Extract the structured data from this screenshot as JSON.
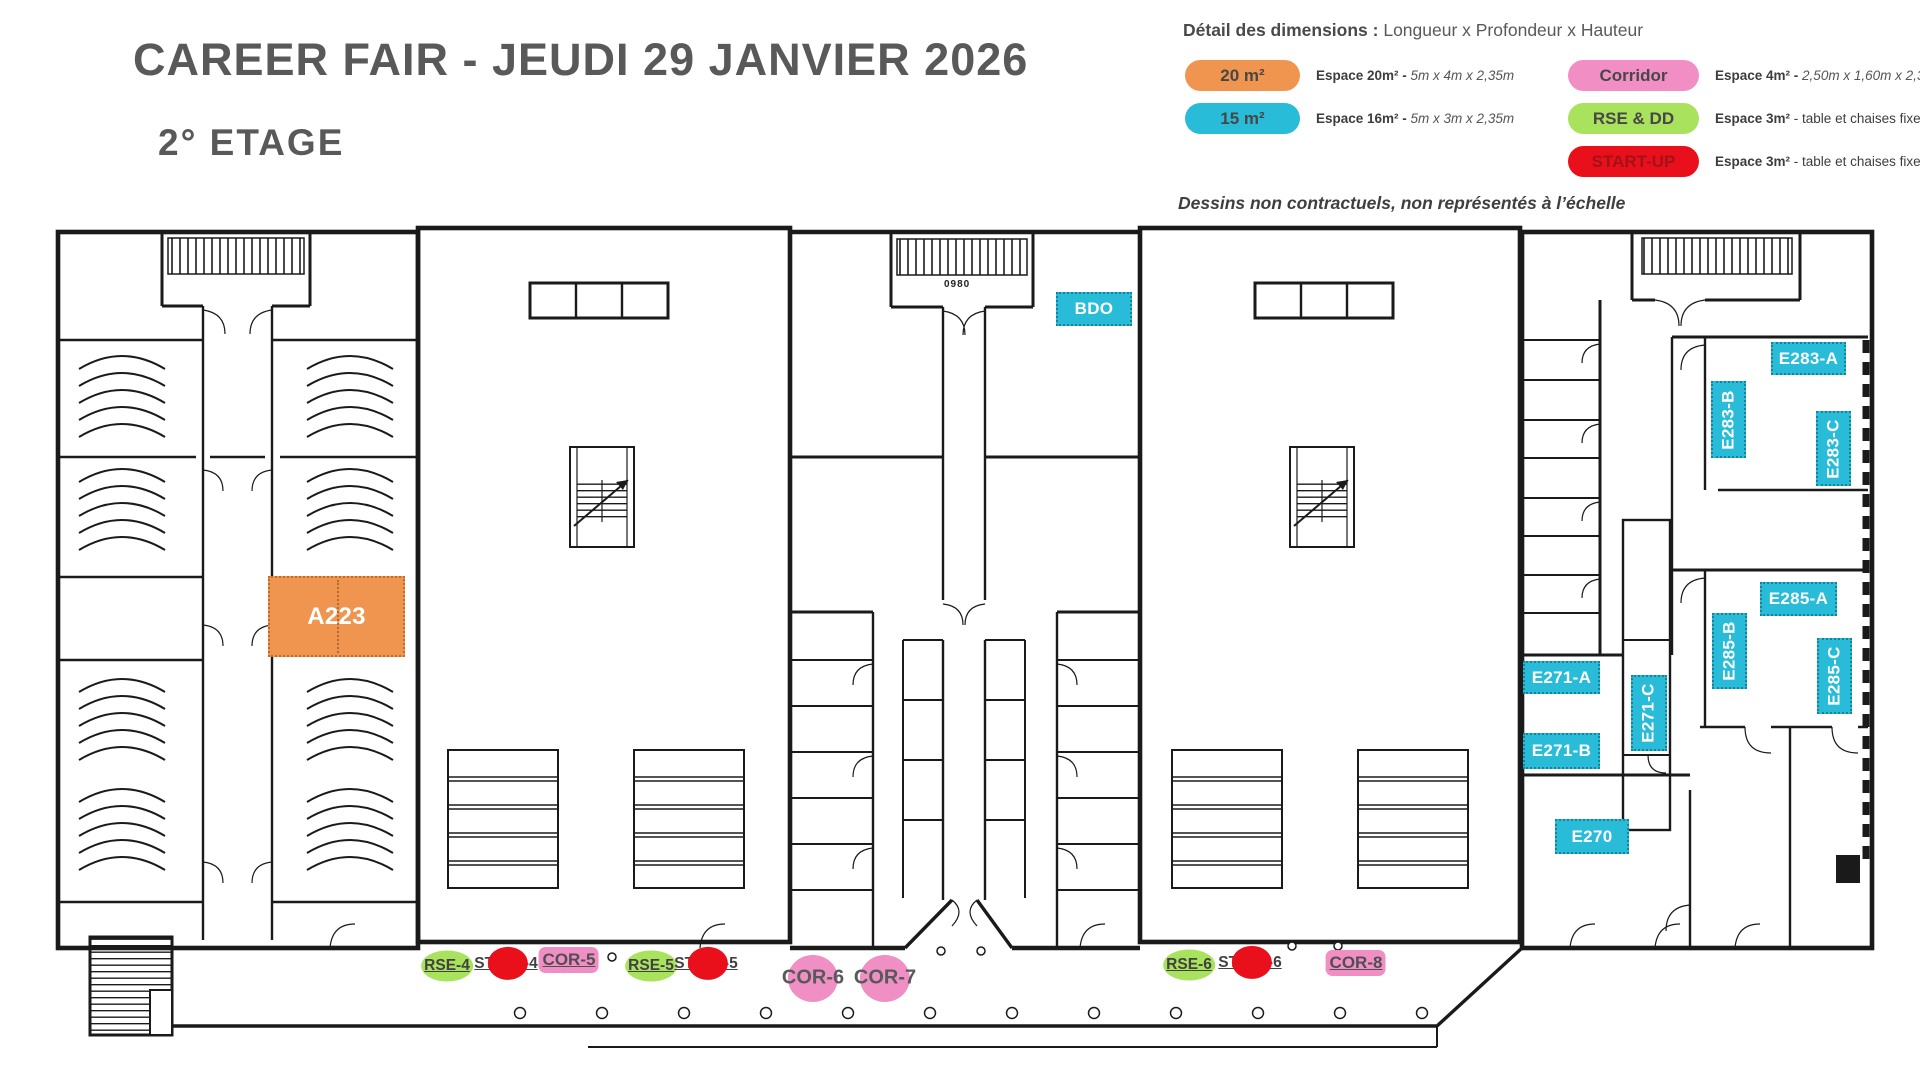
{
  "title": "CAREER FAIR - JEUDI 29 JANVIER 2026",
  "floor_label": "2° ETAGE",
  "note": "Dessins non contractuels, non représentés à l’échelle",
  "legend": {
    "heading_bold": "Détail des dimensions :",
    "heading_rest": " Longueur x Profondeur x Hauteur",
    "items": [
      {
        "label": "20 m²",
        "color": "#F0954F",
        "desc_bold": "Espace 20m² - ",
        "desc_rest": "5m x 4m x 2,35m",
        "rest_italic": true
      },
      {
        "label": "15 m²",
        "color": "#29BCD9",
        "desc_bold": "Espace 16m² - ",
        "desc_rest": "5m x 3m x 2,35m",
        "rest_italic": true
      },
      {
        "label": "Corridor",
        "color": "#F18FC4",
        "desc_bold": "Espace 4m² - ",
        "desc_rest": "2,50m x 1,60m x 2,35m",
        "rest_italic": true
      },
      {
        "label": "RSE & DD",
        "color": "#A9E25D",
        "desc_bold": "Espace 3m²",
        "desc_rest": " - table et chaises fixes",
        "rest_italic": false
      },
      {
        "label": "START-UP",
        "color": "#E90F1B",
        "desc_bold": "Espace 3m²",
        "desc_rest": " - table et chaises fixes",
        "rest_italic": false
      }
    ]
  },
  "colors": {
    "orange": "#F0954F",
    "cyan": "#29BCD9",
    "pink": "#F18FC4",
    "green": "#A9E25D",
    "red": "#E90F1B",
    "title_gray": "#595959",
    "wall": "#1a1a1a"
  },
  "plan": {
    "stair_annotation": "0980",
    "room_labels": [
      {
        "id": "A223",
        "text": "A223",
        "x": 268,
        "y": 576,
        "w": 137,
        "h": 81,
        "vertical": false,
        "style": "orange"
      },
      {
        "id": "BDO",
        "text": "BDO",
        "x": 1056,
        "y": 292,
        "w": 76,
        "h": 34,
        "vertical": false,
        "style": "cyan"
      },
      {
        "id": "E283-A",
        "text": "E283-A",
        "x": 1771,
        "y": 342,
        "w": 75,
        "h": 33,
        "vertical": false,
        "style": "cyan"
      },
      {
        "id": "E283-B",
        "text": "E283-B",
        "x": 1711,
        "y": 381,
        "w": 35,
        "h": 77,
        "vertical": true,
        "style": "cyan"
      },
      {
        "id": "E283-C",
        "text": "E283-C",
        "x": 1816,
        "y": 411,
        "w": 35,
        "h": 75,
        "vertical": true,
        "style": "cyan"
      },
      {
        "id": "E285-A",
        "text": "E285-A",
        "x": 1760,
        "y": 582,
        "w": 77,
        "h": 34,
        "vertical": false,
        "style": "cyan"
      },
      {
        "id": "E285-B",
        "text": "E285-B",
        "x": 1712,
        "y": 613,
        "w": 35,
        "h": 76,
        "vertical": true,
        "style": "cyan"
      },
      {
        "id": "E285-C",
        "text": "E285-C",
        "x": 1817,
        "y": 638,
        "w": 35,
        "h": 76,
        "vertical": true,
        "style": "cyan"
      },
      {
        "id": "E271-A",
        "text": "E271-A",
        "x": 1523,
        "y": 661,
        "w": 77,
        "h": 33,
        "vertical": false,
        "style": "cyan"
      },
      {
        "id": "E271-B",
        "text": "E271-B",
        "x": 1523,
        "y": 733,
        "w": 77,
        "h": 36,
        "vertical": false,
        "style": "cyan"
      },
      {
        "id": "E271-C",
        "text": "E271-C",
        "x": 1631,
        "y": 675,
        "w": 36,
        "h": 76,
        "vertical": true,
        "style": "cyan"
      },
      {
        "id": "E270",
        "text": "E270",
        "x": 1555,
        "y": 819,
        "w": 74,
        "h": 35,
        "vertical": false,
        "style": "cyan"
      }
    ],
    "booths": [
      {
        "id": "RSE-4",
        "text": "RSE-4",
        "kind": "rse",
        "x": 447,
        "y": 966
      },
      {
        "id": "START-4",
        "text": "START-4",
        "kind": "startup",
        "x": 506,
        "y": 964
      },
      {
        "id": "COR-5",
        "text": "COR-5",
        "kind": "cor-rect",
        "x": 569,
        "y": 960
      },
      {
        "id": "RSE-5",
        "text": "RSE-5",
        "kind": "rse",
        "x": 651,
        "y": 966
      },
      {
        "id": "START-5",
        "text": "START-5",
        "kind": "startup",
        "x": 706,
        "y": 964
      },
      {
        "id": "COR-6",
        "text": "COR-6",
        "kind": "cor-circle",
        "x": 813,
        "y": 978
      },
      {
        "id": "COR-7",
        "text": "COR-7",
        "kind": "cor-circle",
        "x": 885,
        "y": 978
      },
      {
        "id": "RSE-6",
        "text": "RSE-6",
        "kind": "rse",
        "x": 1189,
        "y": 965
      },
      {
        "id": "START-6",
        "text": "START-6",
        "kind": "startup",
        "x": 1250,
        "y": 963
      },
      {
        "id": "COR-8",
        "text": "COR-8",
        "kind": "cor-rect",
        "x": 1356,
        "y": 963
      }
    ]
  }
}
